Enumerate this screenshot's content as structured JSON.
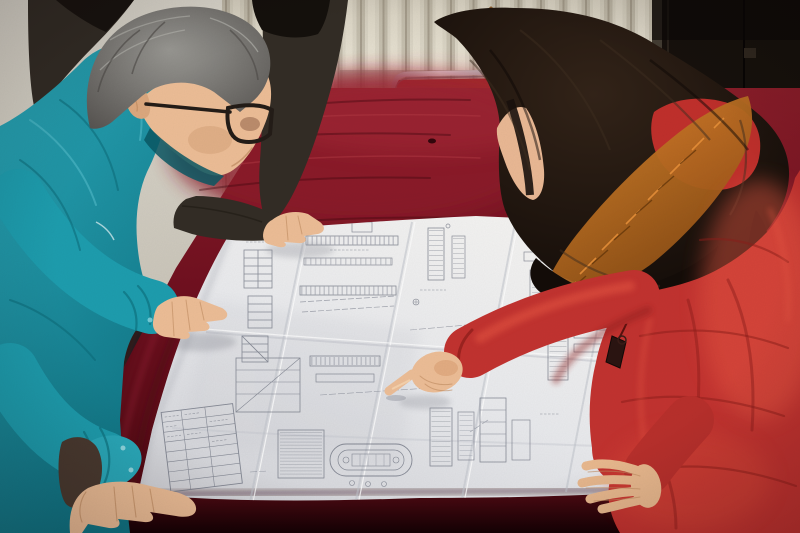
{
  "scene": {
    "alt": "Three people lean over a large folded engineering blueprint spread on a dark crimson velvet table; a gray-haired man in a teal work jacket and glasses studies it on the left, a woman in a red fur-trimmed down coat points at a detail on the right, and the hand of a third dark-clothed person rests on the top edge of the drawing. Behind them are a cream radiator wall, a chrome-edged red chair and a dark door.",
    "people": {
      "left_man": {
        "role": "worker",
        "hair": "gray",
        "eyewear": "glasses",
        "clothing": "teal work jacket"
      },
      "right_woman": {
        "role": "engineer",
        "hair": "long dark wavy",
        "clothing": "red hooded down coat with orange fur trim",
        "action": "pointing at blueprint"
      },
      "background_person": {
        "role": "colleague",
        "clothing": "dark jacket",
        "visible": "black hair, shoulder and hand on blueprint"
      }
    },
    "objects": {
      "blueprint": "large folded white technical drawing with fold creases, section drawings, ladders, hatched blocks, a stadium-shaped tank outline and a title-block table",
      "table": "dark crimson velvet tablecloth",
      "chair": "red chair with chrome tube frame behind table",
      "wall": "cream vertical-fin radiator panel with rust stain",
      "door": "dark brown door at top right"
    }
  },
  "colors": {
    "wall_flat": "#d5d1c8",
    "wall_hi": "#dcd8cd",
    "wall_lo": "#c9c4b8",
    "fin_base": "#e4dfd0",
    "fin_groove": "#a79f8f",
    "fin_mid": "#c6c0b0",
    "fin_hi": "#efeadb",
    "fin_soft": "#cdc7b7",
    "rust": "#7c4a20",
    "door_dark": "#17120d",
    "door_frame": "#453e34",
    "chair_red": "#a32824",
    "chrome_hi": "#f2f4f4",
    "chrome_mid": "#b8bcc0",
    "chrome_shadow": "#787c80",
    "velvet_hi": "#8d1e2a",
    "velvet_mid": "#701120",
    "velvet_dark": "#4c0a12",
    "velvet_deep": "#160205",
    "velvet_streak_dark": "#3f0710",
    "velvet_streak_light": "#b13a44",
    "paper_hi": "#f4f3f1",
    "paper_mid": "#e8e9ec",
    "paper_dim": "#d0d1d6",
    "crease": "#c0c2ca",
    "crease_hi": "#fdfdfd",
    "ink": "#6e7380",
    "ink_dim": "#8a8e9a",
    "teal": "#1e9dae",
    "teal_hi": "#2aa9ba",
    "teal_lo": "#117585",
    "teal_light": "#5cc4d2",
    "teal_fold": "#0c6a78",
    "teal_collar": "#0a5864",
    "hairm_hi": "#9c9b96",
    "hairm_lo": "#565350",
    "skin": "#ecbd96",
    "skin_shadow": "#bf8a5f",
    "glasses": "#241d18",
    "bg_person_jacket": "#332d26",
    "bg_person_hair": "#15110d",
    "sweater_brown": "#4a3a30",
    "hairw_hi": "#332419",
    "hairw_lo": "#140d09",
    "hood_red": "#c0302c",
    "coat_red": "#c23330",
    "coat_light": "#ea5a44",
    "coat_shadow": "#8c1d1a",
    "fur_hi": "#e08a2e",
    "fur_lo": "#8a4c14",
    "zipper_dark": "#2b1512"
  }
}
